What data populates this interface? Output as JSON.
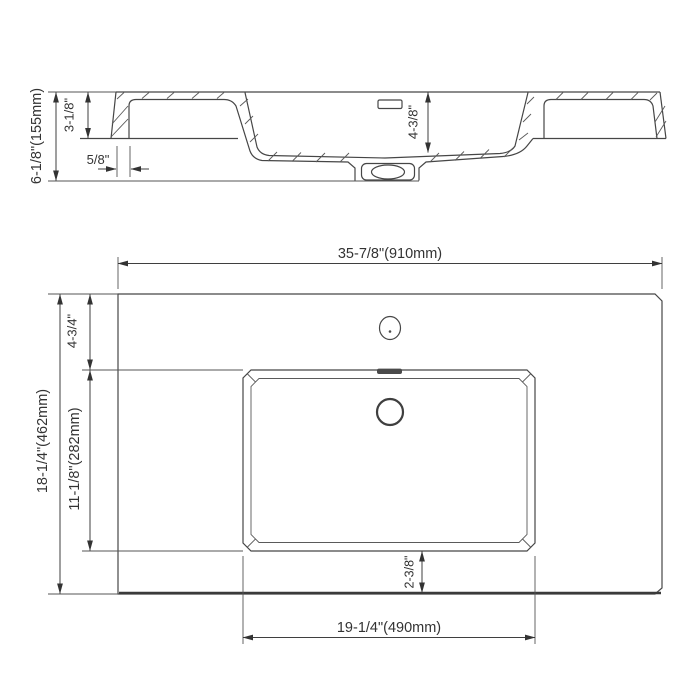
{
  "colors": {
    "line": "#464646",
    "text": "#333333",
    "background": "#ffffff"
  },
  "section_view": {
    "dims": {
      "overall_height": "6-1/8\"(155mm)",
      "rim_to_underside": "3-1/8\"",
      "sidewall_thickness": "5/8\"",
      "basin_depth": "4-3/8\""
    }
  },
  "plan_view": {
    "dims": {
      "overall_width": "35-7/8\"(910mm)",
      "overall_depth": "18-1/4\"(462mm)",
      "top_edge_to_basin": "4-3/4\"",
      "basin_front_back": "11-1/8\"(282mm)",
      "basin_to_front_edge": "2-3/8\"",
      "basin_width": "19-1/4\"(490mm)"
    }
  }
}
